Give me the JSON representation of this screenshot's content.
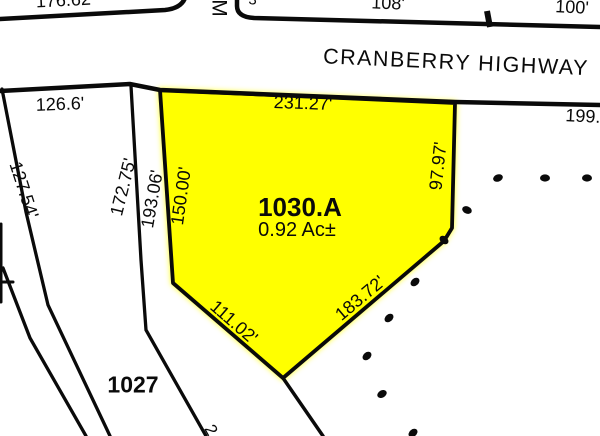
{
  "map": {
    "road_name": "CRANBERRY HIGHWAY",
    "cross_street_partial": "M",
    "parcels": {
      "highlighted": {
        "id": "1030.A",
        "area": "0.92 Ac±"
      },
      "neighbor": {
        "id": "1027"
      }
    },
    "dimensions": {
      "top_left": "176.62'",
      "north_108": "108'",
      "north_100": "100'",
      "west_126": "126.6'",
      "parcel_north_231": "231.27'",
      "east_199": "199.",
      "diag_127": "127.54'",
      "diag_172": "172.75'",
      "diag_193": "193.06'",
      "parcel_west_150": "150.00'",
      "parcel_east_97": "97.97'",
      "parcel_sw_111": "111.02'",
      "parcel_se_183": "183.72'",
      "partial_top": "3'",
      "partial_bottom": "2"
    }
  },
  "colors": {
    "parcel_highlight": "#ffff00",
    "boundary_line": "#0a0a0a",
    "background": "#ffffff"
  }
}
